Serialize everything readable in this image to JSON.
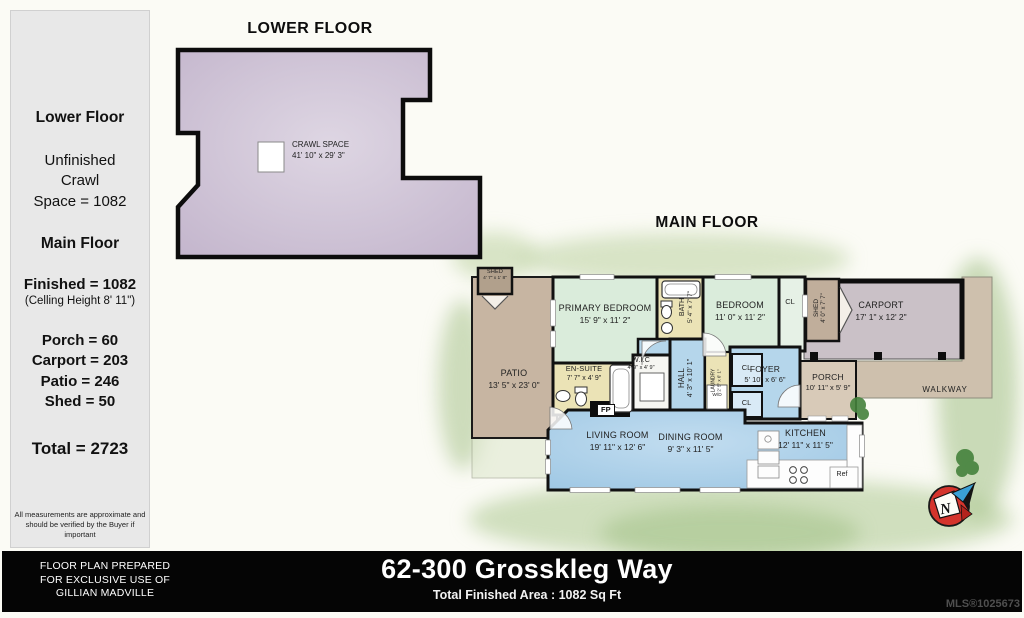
{
  "sidebar": {
    "lower_floor_heading": "Lower Floor",
    "lower_line1": "Unfinished",
    "lower_line2": "Crawl",
    "lower_line3": "Space = 1082",
    "main_floor_heading": "Main Floor",
    "finished": "Finished = 1082",
    "ceiling": "(Celling Height 8' 11\")",
    "area_porch": "Porch = 60",
    "area_carport": "Carport = 203",
    "area_patio": "Patio = 246",
    "area_shed": "Shed = 50",
    "total": "Total = 2723",
    "disclaimer_line1": "All measurements are approximate and",
    "disclaimer_line2": "should be verified by the Buyer if important"
  },
  "lower_floor": {
    "title": "LOWER FLOOR",
    "crawl_space": {
      "name": "CRAWL SPACE",
      "dims": "41' 10\" x 29' 3\""
    }
  },
  "main_floor": {
    "title": "MAIN FLOOR",
    "rooms": {
      "shed_left": {
        "name": "SHED",
        "dims": "4' 7\" x 1' 8\""
      },
      "patio": {
        "name": "PATIO",
        "dims": "13' 5\" x 23' 0\""
      },
      "primary_bedroom": {
        "name": "PRIMARY BEDROOM",
        "dims": "15' 9\" x 11' 2\""
      },
      "bath": {
        "name": "BATH",
        "dims": "5' 4\" x 7' 7\""
      },
      "bedroom": {
        "name": "BEDROOM",
        "dims": "11' 0\" x 11' 2\""
      },
      "closet_bedroom": {
        "label": "CL"
      },
      "shed_right": {
        "name": "SHED",
        "dims": "4' 0\" x 7' 7\""
      },
      "carport": {
        "name": "CARPORT",
        "dims": "17' 1\" x 12' 2\""
      },
      "walkway": {
        "name": "WALKWAY"
      },
      "porch": {
        "name": "PORCH",
        "dims": "10' 11\" x 5' 9\""
      },
      "en_suite": {
        "name": "EN-SUITE",
        "dims": "7' 7\" x 4' 9\""
      },
      "wic": {
        "name": "W.I.C",
        "dims": "4' 9\" x 4' 9\""
      },
      "hall": {
        "name": "HALL",
        "dims": "4' 3\" x 10' 1\""
      },
      "laundry": {
        "name": "LAUNDRY",
        "dims": "2' 5\" x 6' 1\""
      },
      "closet_top": {
        "label": "CL"
      },
      "closet_bottom": {
        "label": "CL"
      },
      "foyer": {
        "name": "FOYER",
        "dims": "5' 10\" x 6' 6\""
      },
      "living_room": {
        "name": "LIVING ROOM",
        "dims": "19' 11\" x 12' 6\""
      },
      "dining_room": {
        "name": "DINING ROOM",
        "dims": "9' 3\" x 11' 5\""
      },
      "kitchen": {
        "name": "KITCHEN",
        "dims": "12' 11\" x 11' 5\""
      },
      "fireplace": "FP",
      "washer_dryer": "W/D",
      "fridge": "Ref"
    },
    "compass": {
      "letter": "N"
    }
  },
  "footer": {
    "prepared_line1": "FLOOR PLAN PREPARED",
    "prepared_line2": "FOR EXCLUSIVE USE OF",
    "prepared_line3": "GILLIAN MADVILLE",
    "address": "62-300 Grosskleg Way",
    "total_area": "Total Finished Area : 1082 Sq Ft",
    "mls": "MLS®1025673"
  },
  "colors": {
    "lavender": "#cbbfd2",
    "bedroom_green": "#daecdb",
    "water_blue": "#aad0e9",
    "bath_yellow": "#ebe3b6",
    "tan": "#c7b5a2",
    "carport_gray": "#cac1c7"
  }
}
